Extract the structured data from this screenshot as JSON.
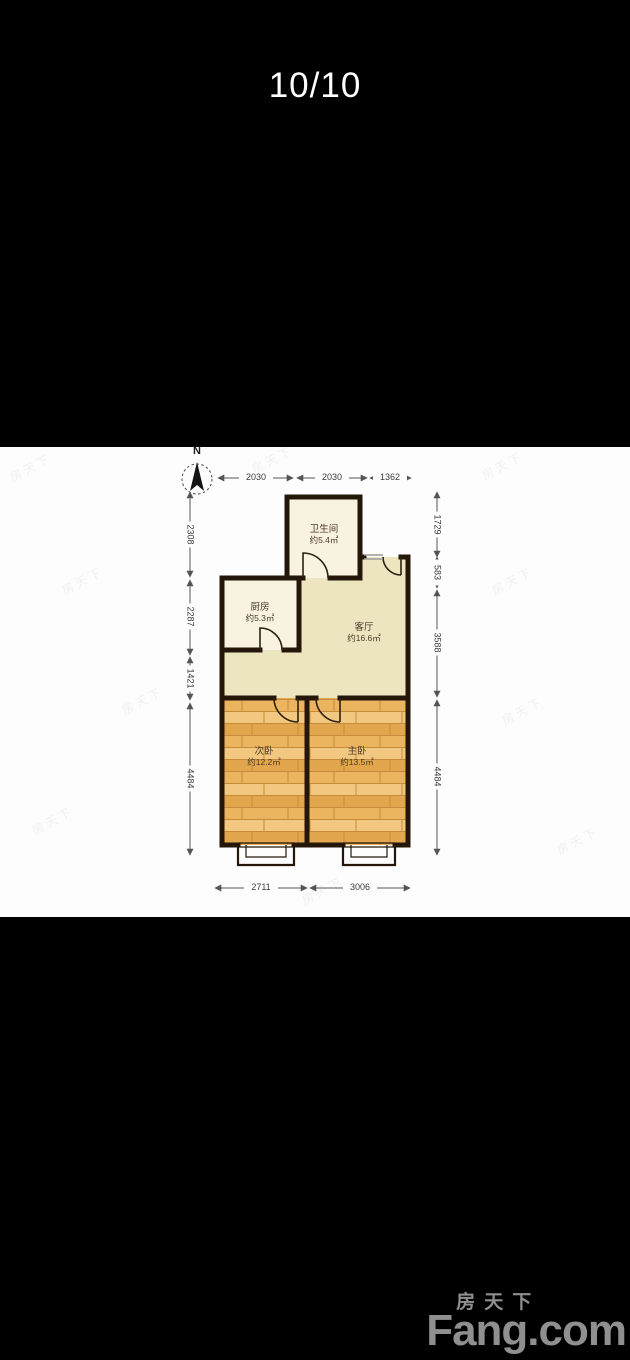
{
  "viewer": {
    "counter": "10/10"
  },
  "floorplan": {
    "compass_label": "N",
    "rooms": {
      "bathroom": {
        "name": "卫生间",
        "area": "约5.4㎡"
      },
      "kitchen": {
        "name": "厨房",
        "area": "约5.3㎡"
      },
      "living": {
        "name": "客厅",
        "area": "约16.6㎡"
      },
      "bedroom2": {
        "name": "次卧",
        "area": "约12.2㎡"
      },
      "bedroom1": {
        "name": "主卧",
        "area": "约13.5㎡"
      }
    },
    "dimensions": {
      "top": [
        "2030",
        "2030",
        "1362"
      ],
      "left": [
        "2308",
        "2287",
        "1421",
        "4484"
      ],
      "right": [
        "1729",
        "583",
        "3588",
        "4484"
      ],
      "bottom": [
        "2711",
        "3006"
      ]
    },
    "colors": {
      "wall": "#241709",
      "tile_floor": "#f8f2e0",
      "living_floor": "#ece5c0",
      "wood_floor": "#eab768",
      "plan_background": "#fdfdfd"
    }
  },
  "watermark": {
    "text": "房天下"
  },
  "logo": {
    "cn": "房天下",
    "en": "Fang.com"
  }
}
